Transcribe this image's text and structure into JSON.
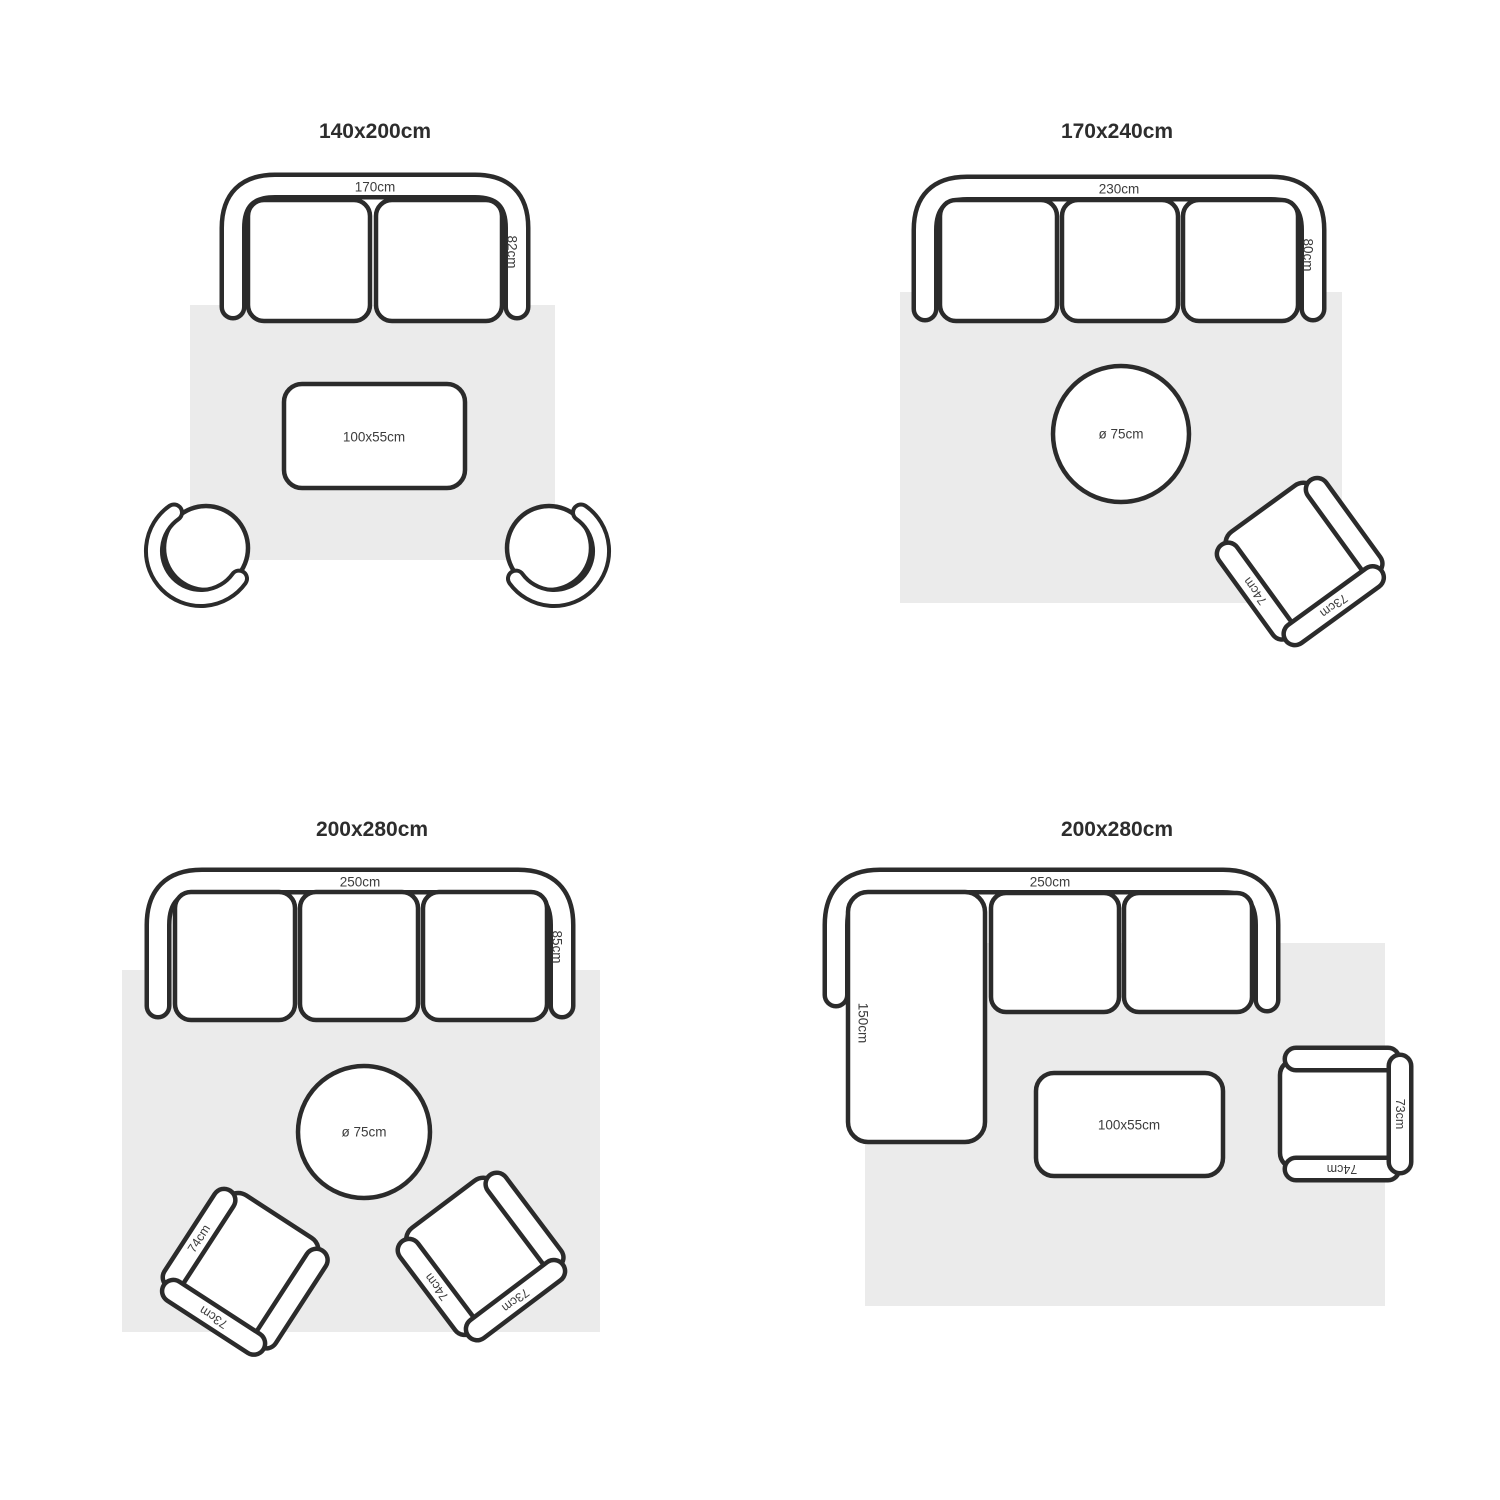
{
  "colors": {
    "background": "#ffffff",
    "line": "#2b2b2b",
    "rug": "#ebebeb",
    "dim_text": "#3c3c3c",
    "title_text": "#2d2d2d"
  },
  "panels": {
    "p1": {
      "title": "140x200cm",
      "sofa_width": "170cm",
      "sofa_depth": "82cm",
      "table": "100x55cm"
    },
    "p2": {
      "title": "170x240cm",
      "sofa_width": "230cm",
      "sofa_depth": "80cm",
      "table": "ø 75cm",
      "chair": {
        "arm": "74cm",
        "back": "73cm"
      }
    },
    "p3": {
      "title": "200x280cm",
      "sofa_width": "250cm",
      "sofa_depth": "85cm",
      "table": "ø 75cm",
      "chair_left": {
        "arm": "74cm",
        "back": "73cm"
      },
      "chair_right": {
        "arm": "74cm",
        "back": "73cm"
      }
    },
    "p4": {
      "title": "200x280cm",
      "sofa_width": "250cm",
      "chaise_depth": "150cm",
      "table": "100x55cm",
      "chair": {
        "arm": "74cm",
        "back": "73cm"
      }
    }
  }
}
